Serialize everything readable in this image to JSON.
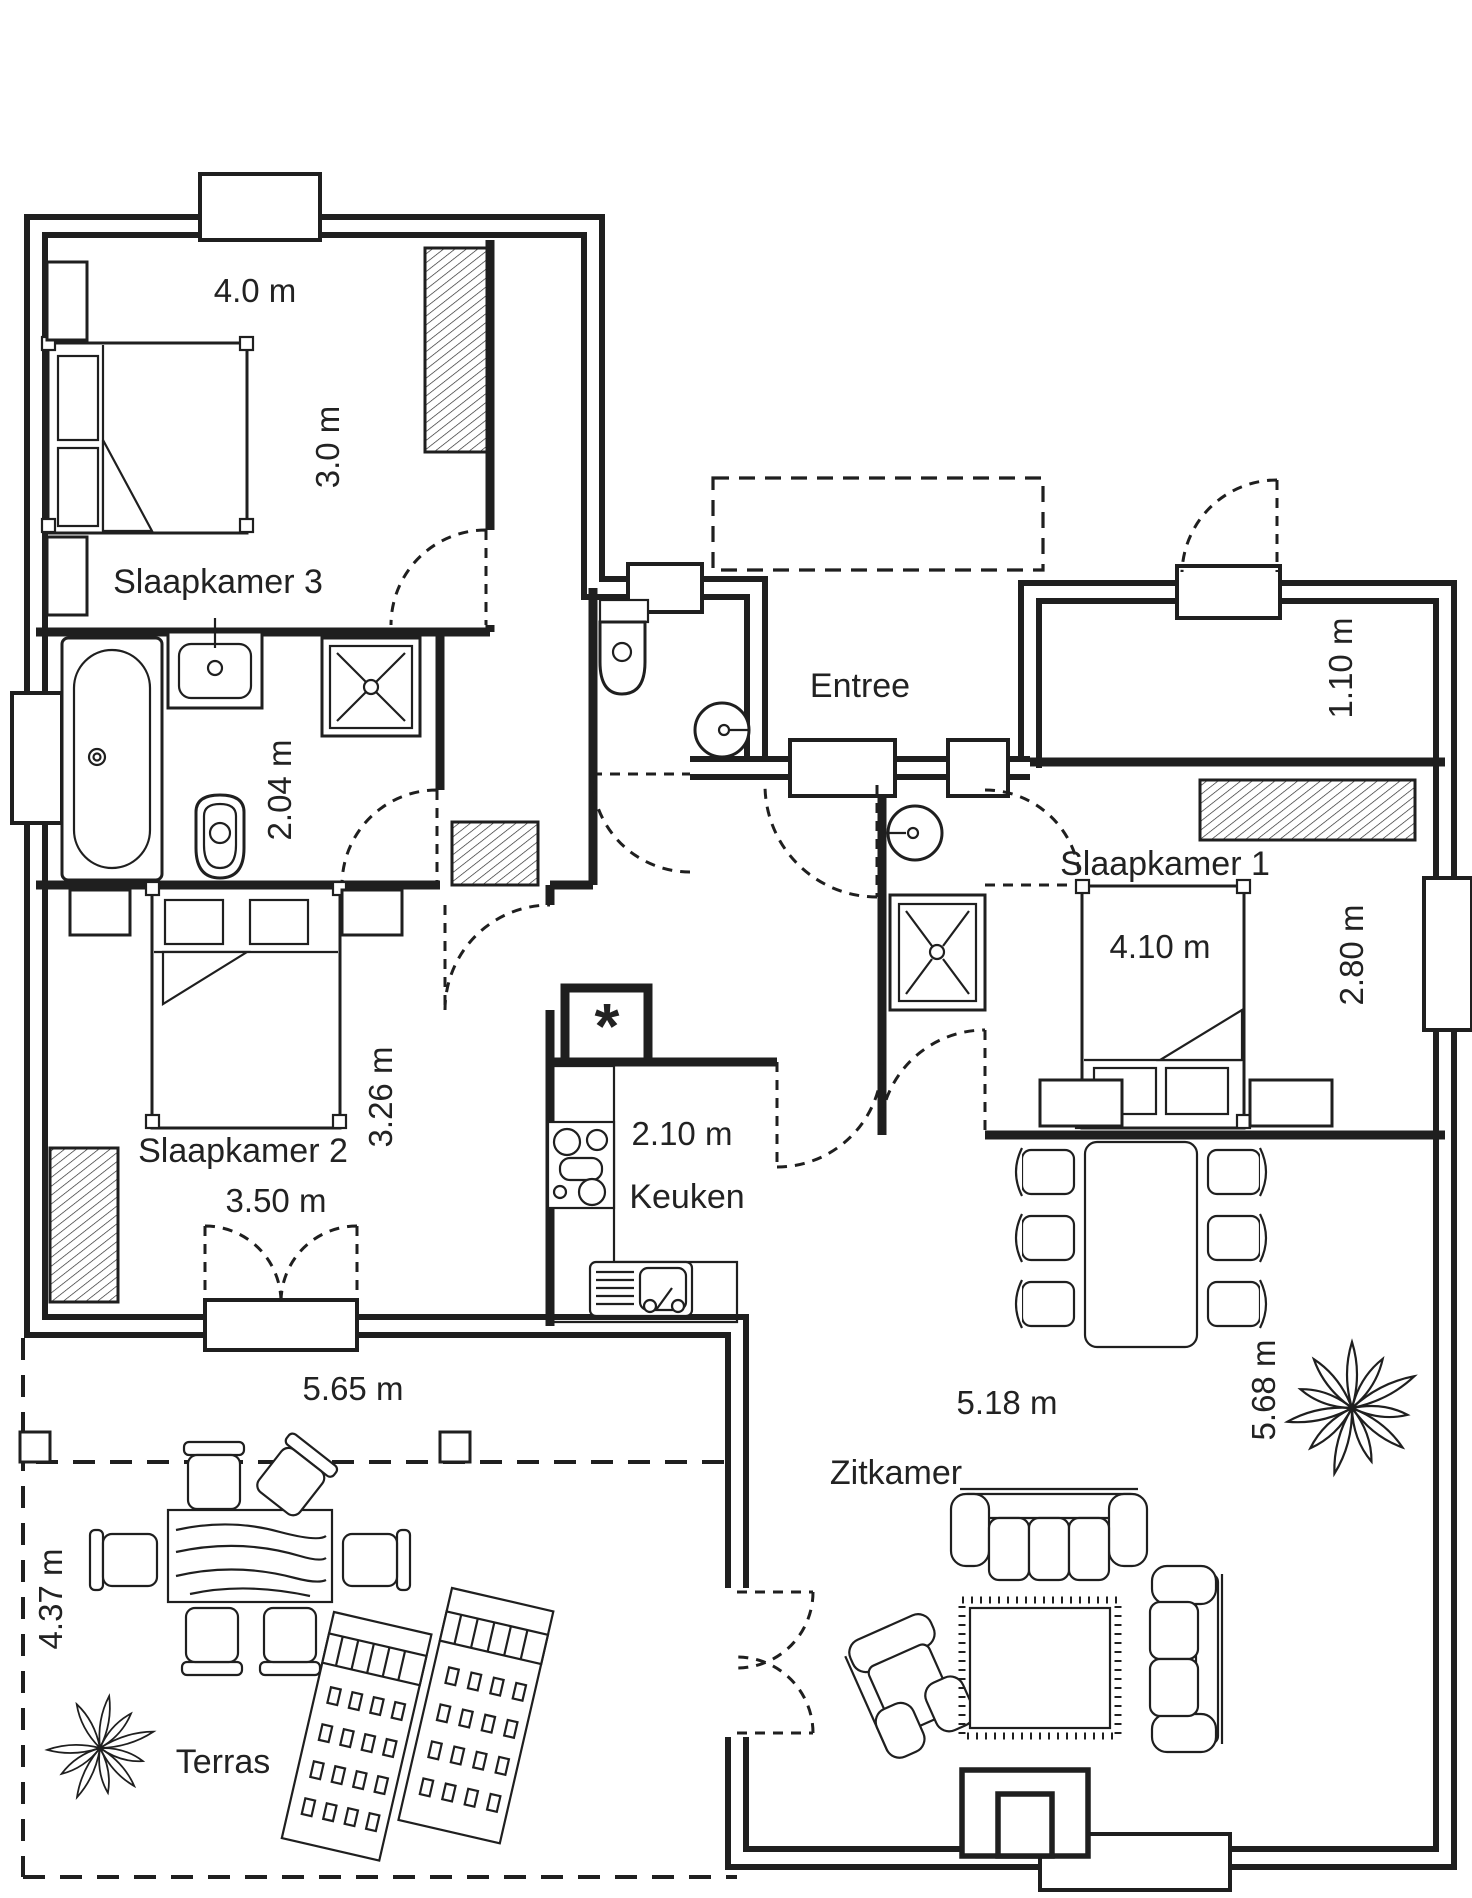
{
  "plan": {
    "type": "residential-floor-plan",
    "language": "nl",
    "colors": {
      "line": "#1f1f1f",
      "background": "#ffffff",
      "text": "#222222"
    },
    "rooms": {
      "slaapkamer3": {
        "name": "Slaapkamer 3",
        "width_label": "4.0 m",
        "depth_label": "3.0 m"
      },
      "badkamer": {
        "depth_label": "2.04 m"
      },
      "entree": {
        "name": "Entree"
      },
      "kast": {
        "depth_label": "1.10 m"
      },
      "slaapkamer1": {
        "name": "Slaapkamer 1",
        "width_label": "4.10 m",
        "depth_label": "2.80 m"
      },
      "slaapkamer2": {
        "name": "Slaapkamer 2",
        "width_label": "3.50 m",
        "depth_label": "3.26 m"
      },
      "keuken": {
        "name": "Keuken",
        "width_label": "2.10 m"
      },
      "zitkamer": {
        "name": "Zitkamer",
        "width_label": "5.18 m",
        "depth_label": "5.68 m"
      },
      "terras": {
        "name": "Terras",
        "width_label": "5.65 m",
        "depth_label": "4.37 m"
      }
    },
    "symbols": {
      "technical_room_marker": "*"
    }
  }
}
